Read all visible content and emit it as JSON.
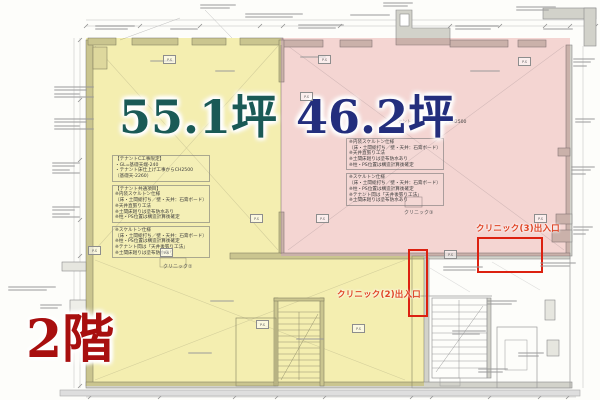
{
  "floor": {
    "label": "2階"
  },
  "areas": {
    "yellow": {
      "size_label": "55.1坪",
      "fill": "#f6f0b4",
      "label_color": "#1a5a56"
    },
    "pink": {
      "size_label": "46.2坪",
      "fill": "#f6d7d7",
      "label_color": "#232e7d"
    }
  },
  "entrances": {
    "clinic3": "クリニック(3)出入口",
    "clinic2": "クリニック(2)出入口",
    "accent_color": "#dc2110"
  },
  "room_labels": {
    "clinic2": "クリニック②",
    "clinic3": "クリニック③"
  },
  "ps_label": "P.S",
  "notes": {
    "pink_header": "テナント床仕上げ工事からCH2500",
    "tenant_c": [
      "【テナントC工事限定】",
      "・GL=基礎天端-240",
      "・テナント床仕上げ工事からCH2500",
      "（基礎天-2260）"
    ],
    "tenant_common": [
      "【テナント共通項目】",
      "※内装スケルトン仕様",
      "（床・土間総打ち／壁・天井：石膏ボード）",
      "※天井直張り工法",
      "※土間床廻りは塗布防水あり",
      "※柱・PS位置は構造計算後確定"
    ],
    "skeleton": [
      "※スケルトン仕様",
      "（床・土間総打ち／壁・天井：石膏ボード）",
      "※柱・PS位置は構造計算後確定",
      "※テナント間は「天井後張り工法」",
      "※土間床廻りは塗布防水あり"
    ],
    "pink_a": [
      "※内装スケルトン仕様",
      "（床・土間総打ち／壁・天井：石膏ボード）",
      "※天井直張り工法",
      "※土間床廻りは塗布防水あり",
      "※柱・PS位置は構造計算後確定"
    ],
    "pink_b": [
      "※スケルトン仕様",
      "（床・土間総打ち／壁・天井：石膏ボード）",
      "※柱・PS位置は構造計算後確定",
      "※テナント間は「天井後張り工法」",
      "※土間床廻りは塗布防水あり"
    ]
  }
}
